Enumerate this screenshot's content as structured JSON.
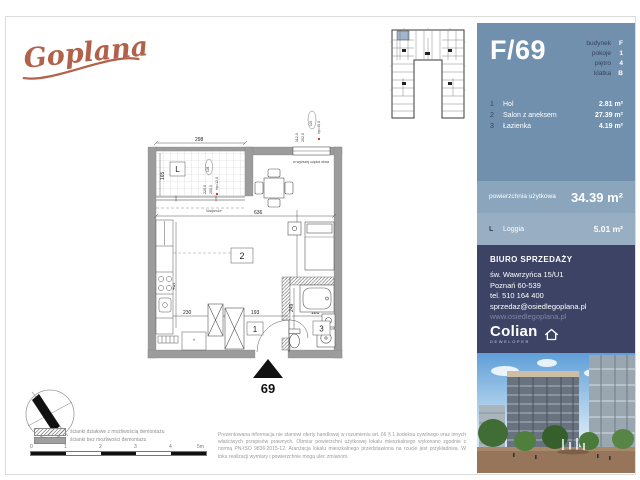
{
  "brand": {
    "name": "Goplana"
  },
  "unit": {
    "id": "F/69",
    "attrs": [
      {
        "label": "budynek",
        "value": "F"
      },
      {
        "label": "pokoje",
        "value": "1"
      },
      {
        "label": "piętro",
        "value": "4"
      },
      {
        "label": "klatka",
        "value": "B"
      }
    ],
    "rooms": [
      {
        "no": "1",
        "name": "Hol",
        "area": "2.81 m²"
      },
      {
        "no": "2",
        "name": "Salon z aneksem",
        "area": "27.39 m²"
      },
      {
        "no": "3",
        "name": "Łazienka",
        "area": "4.19 m²"
      }
    ],
    "usable_area_label": "powierzchnia użytkowa",
    "usable_area_value": "34.39 m²",
    "loggia_no": "L",
    "loggia_label": "Loggia",
    "loggia_value": "5.01 m²"
  },
  "office": {
    "title": "BIURO SPRZEDAŻY",
    "address1": "św. Wawrzyńca 15/U1",
    "address2": "Poznań 60-539",
    "phone": "tel. 510 164 400",
    "email": "sprzedaz@osiedlegoplana.pl",
    "website": "www.osiedlegoplana.pl",
    "developer": "Colian",
    "developer_sub": "DEWELOPER"
  },
  "plan": {
    "entry_no": "69",
    "labels": {
      "loggia": "L",
      "salon": "2",
      "hall": "1",
      "bath": "3"
    },
    "dims": {
      "d298": "298",
      "d165": "165",
      "d636": "636",
      "d402": "402",
      "d497": "497",
      "d230": "230",
      "d193": "193",
      "d181": "181",
      "d249": "249"
    },
    "ann": {
      "win_w": "112,0",
      "win_h": "202,0",
      "win_id": "129",
      "win_hp": "hp=45,0",
      "log_w": "220,0",
      "log_h": "200,0",
      "log_id": "128",
      "log_hp": "hp=12,0",
      "window_note": "w wyższej części okna",
      "lintel": "Nadproże"
    }
  },
  "legend": {
    "items": [
      {
        "label": "ścianki działowe z możliwością demontażu"
      },
      {
        "label": "ścianki bez możliwości demontażu"
      }
    ]
  },
  "scalebar": {
    "t0": "0",
    "t1": "1",
    "t2": "2",
    "t3": "3",
    "t4": "4",
    "t5": "5m"
  },
  "disclaimer": "Prezentowana informacja nie stanowi oferty handlowej w rozumieniu art. 66 § 1 kodeksu cywilnego oraz innych właściwych przepisów prawnych. Obmiar powierzchni użytkowej lokalu mieszkalnego wykonano zgodnie z normą PN-ISO 9836:2015-12. Aranżacja lokalu mieszkalnego przedstawiona na rzucie jest przykładowa. W toku realizacji wymiary i powierzchnie mogą ulec zmianom.",
  "colors": {
    "sidebar_blue": "#7190ae",
    "band1": "#8aa5bc",
    "band2": "#97aec3",
    "navy": "#3d4364",
    "brand_red": "#b2624a",
    "wall_gray": "#9c9c9c"
  }
}
